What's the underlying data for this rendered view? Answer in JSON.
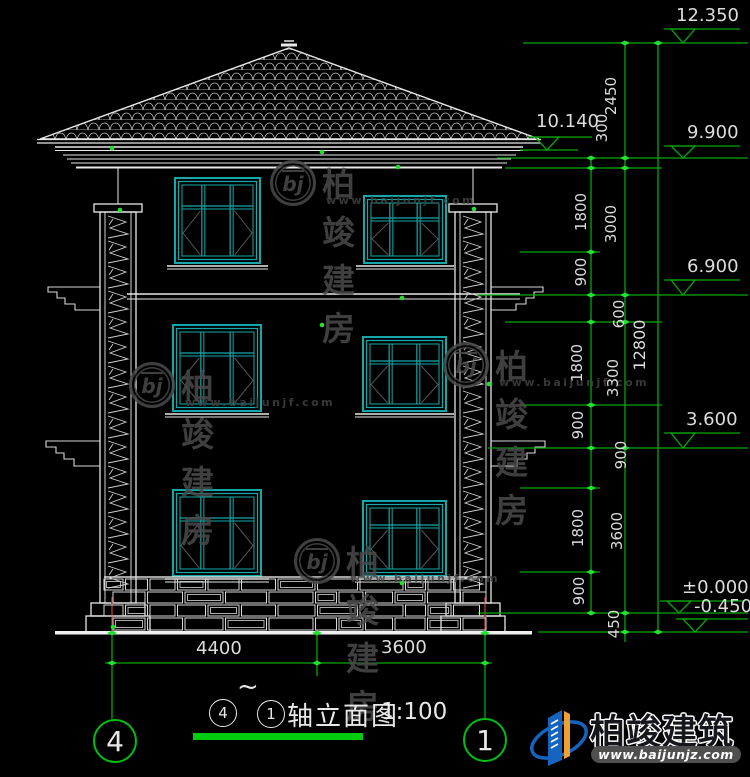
{
  "levels": {
    "l12350": "12.350",
    "l10140": "10.140",
    "l9900": "9.900",
    "l6900": "6.900",
    "l3600": "3.600",
    "l0": "±0.000",
    "ln450": "-0.450"
  },
  "chain_inner": {
    "s1": "1800",
    "s2": "900",
    "s3": "1800",
    "s4": "900",
    "s5": "1800",
    "s6": "900"
  },
  "chain_mid": {
    "s1": "2450",
    "s2": "300",
    "s3": "3000",
    "s4": "600",
    "s5": "3300",
    "s6": "900",
    "s7": "3600",
    "s8": "450"
  },
  "chain_total": {
    "s1": "12800"
  },
  "dims_bottom": {
    "d1": "4400",
    "d2": "3600"
  },
  "title_block": {
    "from_axis": "4",
    "tilde": "~",
    "to_axis": "1",
    "label": "轴立面图",
    "scale": "1:100"
  },
  "axis_bubbles": {
    "left": "4",
    "right": "1"
  },
  "watermark": {
    "logo_text": "bj",
    "title": "柏竣建房",
    "url": "www.baijunjf.com"
  },
  "brand": {
    "name": "柏竣建筑",
    "url": "www.baijunjz.com"
  },
  "colors": {
    "dim_green": "#00a80a",
    "tick_green": "#1fe32f",
    "line_white": "#e8e8e8",
    "window_teal": "#14a8a8",
    "watermark_gray": "#4a4a4a",
    "brand_blue": "#1565c0",
    "brand_orange": "#f0a030",
    "axis_red": "#9c2b2b"
  }
}
